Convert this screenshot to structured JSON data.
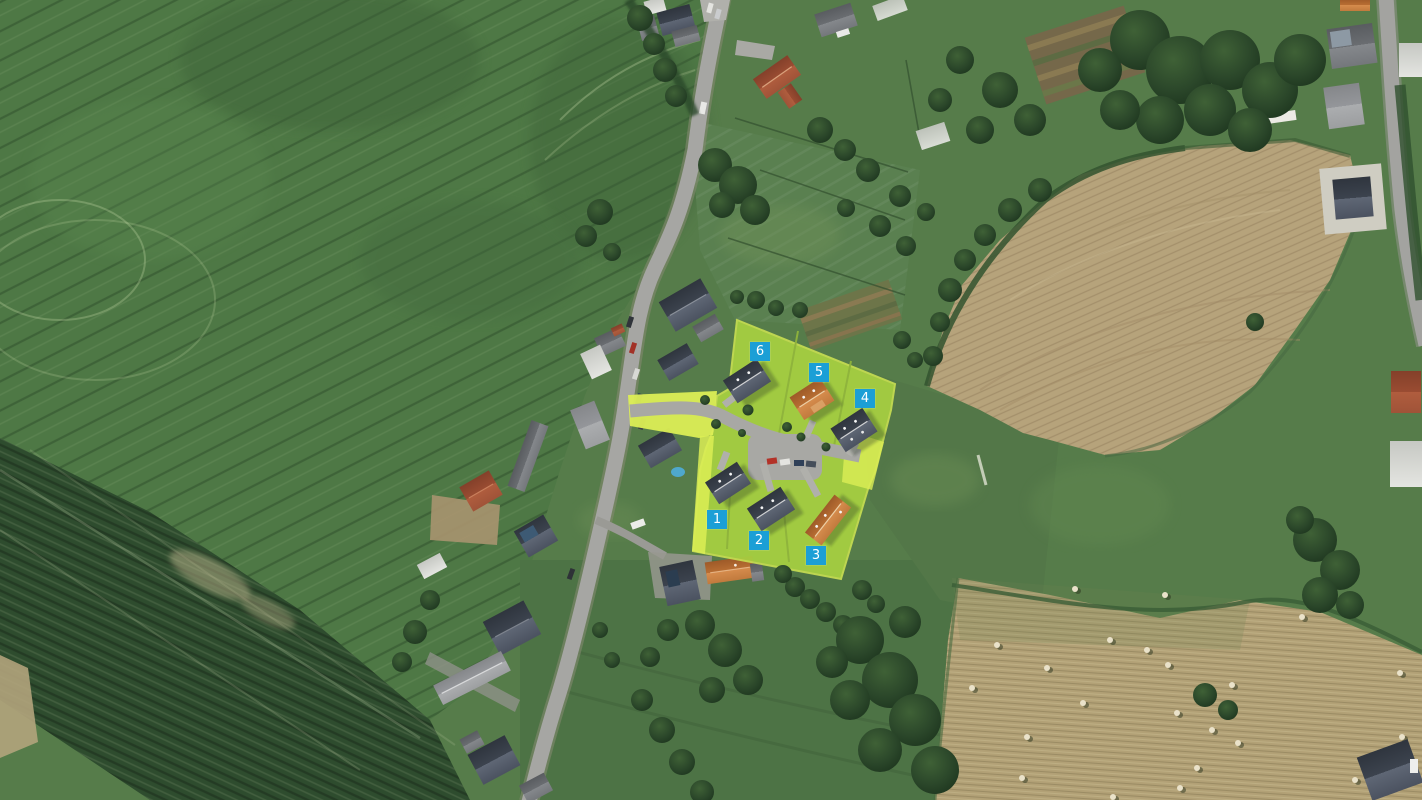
{
  "site": {
    "description_colors": {
      "marker_blue": "#1b9fd6",
      "overlay_lime": "#a7d041",
      "access_road_lime": "#dcee55",
      "proposed_house_dark_roof": "#3c434e",
      "proposed_house_orange_roof": "#c17a3d"
    },
    "plots": [
      {
        "number": "1"
      },
      {
        "number": "2"
      },
      {
        "number": "3"
      },
      {
        "number": "4"
      },
      {
        "number": "5"
      },
      {
        "number": "6"
      }
    ],
    "houses": [
      {
        "plot": "1",
        "roof": "dark-gray"
      },
      {
        "plot": "2",
        "roof": "dark-gray"
      },
      {
        "plot": "3",
        "roof": "orange"
      },
      {
        "plot": "4",
        "roof": "dark-gray"
      },
      {
        "plot": "5",
        "roof": "orange"
      },
      {
        "plot": "6",
        "roof": "dark-gray"
      }
    ]
  }
}
